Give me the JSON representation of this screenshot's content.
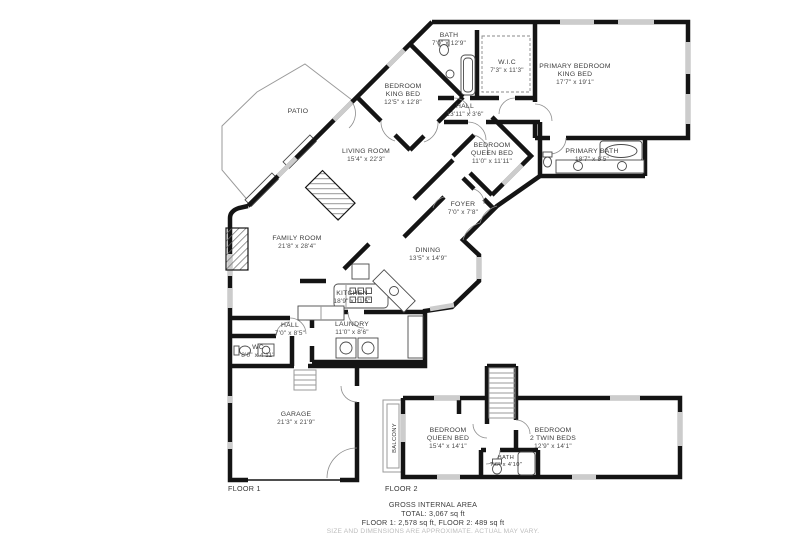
{
  "colors": {
    "wall": "#141414",
    "window": "#cccccc",
    "outline": "#9a9a9a",
    "text": "#3c3c3c",
    "muted": "#bdbdbd"
  },
  "floor_labels": {
    "floor1": "FLOOR 1",
    "floor2": "FLOOR 2"
  },
  "rooms": {
    "bath_upper": {
      "name": "BATH",
      "dims": "7'0\" x 12'9\""
    },
    "wic": {
      "name": "W.I.C",
      "dims": "7'3\" x 11'3\""
    },
    "primary_bedroom": {
      "name": "PRIMARY BEDROOM",
      "name2": "KING BED",
      "dims": "17'7\" x 19'1\""
    },
    "bedroom_king": {
      "name": "BEDROOM",
      "name2": "KING BED",
      "dims": "12'5\" x 12'8\""
    },
    "hall_upper": {
      "name": "HALL",
      "dims": "13'11\" x 3'6\""
    },
    "patio": {
      "name": "PATIO"
    },
    "living_room": {
      "name": "LIVING ROOM",
      "dims": "15'4\" x 22'3\""
    },
    "bedroom_queen_f1": {
      "name": "BEDROOM",
      "name2": "QUEEN BED",
      "dims": "11'0\" x 11'11\""
    },
    "primary_bath": {
      "name": "PRIMARY BATH",
      "dims": "18'7\" x 8'5\""
    },
    "foyer": {
      "name": "FOYER",
      "dims": "7'0\" x 7'8\""
    },
    "family_room": {
      "name": "FAMILY ROOM",
      "dims": "21'8\" x 28'4\""
    },
    "dining": {
      "name": "DINING",
      "dims": "13'5\" x 14'9\""
    },
    "kitchen": {
      "name": "KITCHEN",
      "dims": "18'9\" x 11'5\""
    },
    "hall_lower": {
      "name": "HALL",
      "dims": "7'0\" x 8'5\""
    },
    "laundry": {
      "name": "LAUNDRY",
      "dims": "11'0\" x 8'6\""
    },
    "wc": {
      "name": "WC",
      "dims": "8'0\" x 4'11\""
    },
    "garage": {
      "name": "GARAGE",
      "dims": "21'3\" x 21'9\""
    },
    "balcony": {
      "name": "BALCONY"
    },
    "bedroom_queen_f2": {
      "name": "BEDROOM",
      "name2": "QUEEN BED",
      "dims": "15'4\" x 14'1\""
    },
    "bedroom_twin_f2": {
      "name": "BEDROOM",
      "name2": "2 TWIN BEDS",
      "dims": "12'9\" x 14'1\""
    },
    "bath_f2": {
      "name": "BATH",
      "dims": "7'6\" x 4'10\""
    }
  },
  "footer": {
    "heading": "GROSS INTERNAL AREA",
    "total": "TOTAL: 3,067 sq ft",
    "floors": "FLOOR 1: 2,578 sq ft, FLOOR 2: 489 sq ft",
    "disclaimer": "SIZE AND DIMENSIONS ARE APPROXIMATE, ACTUAL MAY VARY."
  }
}
